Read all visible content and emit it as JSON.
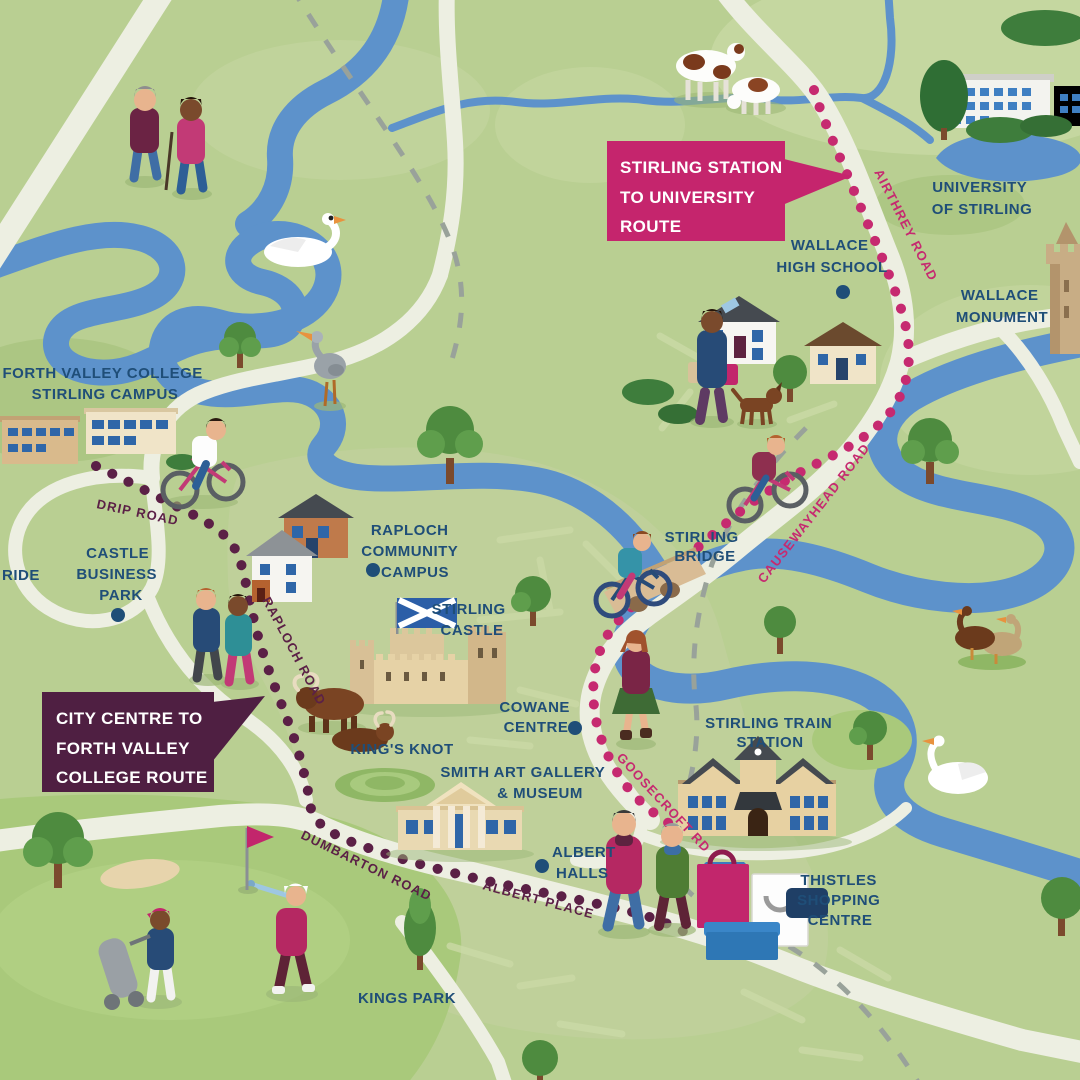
{
  "colors": {
    "map-bg": "#b9cf92",
    "map-light": "#c7d7a2",
    "map-urban": "#bfd09b",
    "map-dark": "#a2bf76",
    "golf-green": "#a9c97b",
    "river": "#5d92cb",
    "road": "#edefe2",
    "path-dash": "#99a29a",
    "route-pink": "#c62a70",
    "route-purple": "#5b2046",
    "label-blue": "#1f4e78",
    "callout-pink": "#c5256d",
    "callout-purple": "#4f1f42",
    "callout-text": "#ffffff"
  },
  "callouts": {
    "station_university": {
      "lines": [
        "STIRLING STATION",
        "TO UNIVERSITY",
        "ROUTE"
      ]
    },
    "city_college": {
      "lines": [
        "CITY CENTRE TO",
        "FORTH VALLEY",
        "COLLEGE ROUTE"
      ]
    }
  },
  "places": {
    "university": {
      "lines": [
        "UNIVERSITY",
        "OF STIRLING"
      ]
    },
    "wallace_high": {
      "lines": [
        "WALLACE",
        "HIGH SCHOOL"
      ]
    },
    "wallace_monument": {
      "lines": [
        "WALLACE",
        "MONUMENT"
      ]
    },
    "forth_valley": {
      "lines": [
        "FORTH VALLEY COLLEGE",
        "STIRLING CAMPUS"
      ]
    },
    "park_ride": {
      "lines": [
        "RIDE"
      ]
    },
    "castle_business": {
      "lines": [
        "CASTLE",
        "BUSINESS",
        "PARK"
      ]
    },
    "raploch_campus": {
      "lines": [
        "RAPLOCH",
        "COMMUNITY",
        "CAMPUS"
      ]
    },
    "stirling_castle": {
      "lines": [
        "STIRLING",
        "CASTLE"
      ]
    },
    "stirling_bridge": {
      "lines": [
        "STIRLING",
        "BRIDGE"
      ]
    },
    "cowane": {
      "lines": [
        "COWANE",
        "CENTRE"
      ]
    },
    "kings_knot": {
      "lines": [
        "KING'S KNOT"
      ]
    },
    "smith_gallery": {
      "lines": [
        "SMITH ART GALLERY",
        "& MUSEUM"
      ]
    },
    "albert_halls": {
      "lines": [
        "ALBERT",
        "HALLS"
      ]
    },
    "train_station": {
      "lines": [
        "STIRLING TRAIN",
        "STATION"
      ]
    },
    "thistles": {
      "lines": [
        "THISTLES",
        "SHOPPING",
        "CENTRE"
      ]
    },
    "kings_park": {
      "lines": [
        "KINGS PARK"
      ]
    }
  },
  "roads": {
    "airthrey": "AIRTHREY ROAD",
    "causewayhead": "CAUSEWAYHEAD ROAD",
    "goosecroft": "GOOSECROFT RD",
    "drip": "DRIP ROAD",
    "raploch": "RAPLOCH ROAD",
    "dumbarton": "DUMBARTON ROAD",
    "albert_place": "ALBERT PLACE"
  }
}
